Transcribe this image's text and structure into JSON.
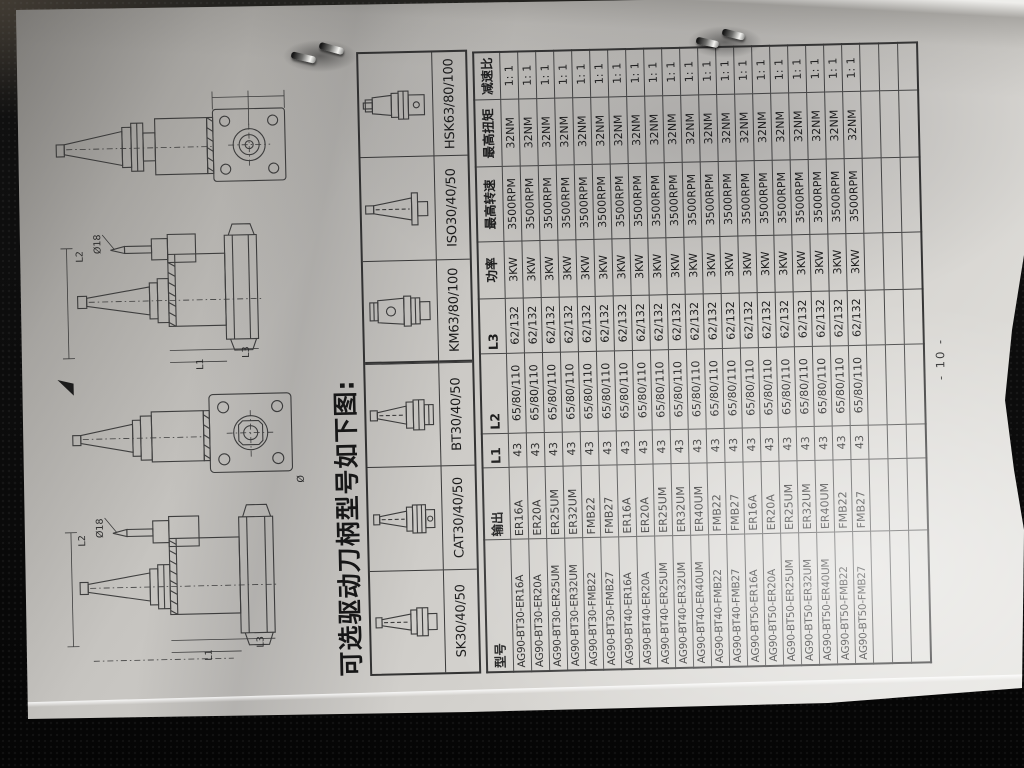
{
  "page": {
    "heading": "可选驱动刀柄型号如下图:",
    "page_number": "- 10 -"
  },
  "holder_band": {
    "items": [
      {
        "label": "SK30/40/50",
        "icon": "sk-taper-shank-icon"
      },
      {
        "label": "CAT30/40/50",
        "icon": "cat-taper-shank-icon"
      },
      {
        "label": "BT30/40/50",
        "icon": "bt-taper-shank-icon"
      },
      {
        "label": "KM63/80/100",
        "icon": "km-shank-icon"
      },
      {
        "label": "ISO30/40/50",
        "icon": "iso-taper-shank-icon"
      },
      {
        "label": "HSK63/80/100",
        "icon": "hsk-shank-icon"
      }
    ]
  },
  "drawings": {
    "labels": {
      "diameter": "Ø18",
      "l1": "L1",
      "l2": "L2",
      "l3": "L3",
      "dia": "Ø"
    }
  },
  "spec_table": {
    "columns": [
      "型号",
      "输出",
      "L1",
      "L2",
      "L3",
      "功率",
      "最高转速",
      "最高扭矩",
      "减速比"
    ],
    "rows": [
      [
        "AG90-BT30-ER16A",
        "ER16A",
        "43",
        "65/80/110",
        "62/132",
        "3KW",
        "3500RPM",
        "32NM",
        "1: 1"
      ],
      [
        "AG90-BT30-ER20A",
        "ER20A",
        "43",
        "65/80/110",
        "62/132",
        "3KW",
        "3500RPM",
        "32NM",
        "1: 1"
      ],
      [
        "AG90-BT30-ER25UM",
        "ER25UM",
        "43",
        "65/80/110",
        "62/132",
        "3KW",
        "3500RPM",
        "32NM",
        "1: 1"
      ],
      [
        "AG90-BT30-ER32UM",
        "ER32UM",
        "43",
        "65/80/110",
        "62/132",
        "3KW",
        "3500RPM",
        "32NM",
        "1: 1"
      ],
      [
        "AG90-BT30-FMB22",
        "FMB22",
        "43",
        "65/80/110",
        "62/132",
        "3KW",
        "3500RPM",
        "32NM",
        "1: 1"
      ],
      [
        "AG90-BT30-FMB27",
        "FMB27",
        "43",
        "65/80/110",
        "62/132",
        "3KW",
        "3500RPM",
        "32NM",
        "1: 1"
      ],
      [
        "AG90-BT40-ER16A",
        "ER16A",
        "43",
        "65/80/110",
        "62/132",
        "3KW",
        "3500RPM",
        "32NM",
        "1: 1"
      ],
      [
        "AG90-BT40-ER20A",
        "ER20A",
        "43",
        "65/80/110",
        "62/132",
        "3KW",
        "3500RPM",
        "32NM",
        "1: 1"
      ],
      [
        "AG90-BT40-ER25UM",
        "ER25UM",
        "43",
        "65/80/110",
        "62/132",
        "3KW",
        "3500RPM",
        "32NM",
        "1: 1"
      ],
      [
        "AG90-BT40-ER32UM",
        "ER32UM",
        "43",
        "65/80/110",
        "62/132",
        "3KW",
        "3500RPM",
        "32NM",
        "1: 1"
      ],
      [
        "AG90-BT40-ER40UM",
        "ER40UM",
        "43",
        "65/80/110",
        "62/132",
        "3KW",
        "3500RPM",
        "32NM",
        "1: 1"
      ],
      [
        "AG90-BT40-FMB22",
        "FMB22",
        "43",
        "65/80/110",
        "62/132",
        "3KW",
        "3500RPM",
        "32NM",
        "1: 1"
      ],
      [
        "AG90-BT40-FMB27",
        "FMB27",
        "43",
        "65/80/110",
        "62/132",
        "3KW",
        "3500RPM",
        "32NM",
        "1: 1"
      ],
      [
        "AG90-BT50-ER16A",
        "ER16A",
        "43",
        "65/80/110",
        "62/132",
        "3KW",
        "3500RPM",
        "32NM",
        "1: 1"
      ],
      [
        "AG90-BT50-ER20A",
        "ER20A",
        "43",
        "65/80/110",
        "62/132",
        "3KW",
        "3500RPM",
        "32NM",
        "1: 1"
      ],
      [
        "AG90-BT50-ER25UM",
        "ER25UM",
        "43",
        "65/80/110",
        "62/132",
        "3KW",
        "3500RPM",
        "32NM",
        "1: 1"
      ],
      [
        "AG90-BT50-ER32UM",
        "ER32UM",
        "43",
        "65/80/110",
        "62/132",
        "3KW",
        "3500RPM",
        "32NM",
        "1: 1"
      ],
      [
        "AG90-BT50-ER40UM",
        "ER40UM",
        "43",
        "65/80/110",
        "62/132",
        "3KW",
        "3500RPM",
        "32NM",
        "1: 1"
      ],
      [
        "AG90-BT50-FMB22",
        "FMB22",
        "43",
        "65/80/110",
        "62/132",
        "3KW",
        "3500RPM",
        "32NM",
        "1: 1"
      ],
      [
        "AG90-BT50-FMB27",
        "FMB27",
        "43",
        "65/80/110",
        "62/132",
        "3KW",
        "3500RPM",
        "32NM",
        "1: 1"
      ]
    ],
    "empty_rows": 3
  }
}
